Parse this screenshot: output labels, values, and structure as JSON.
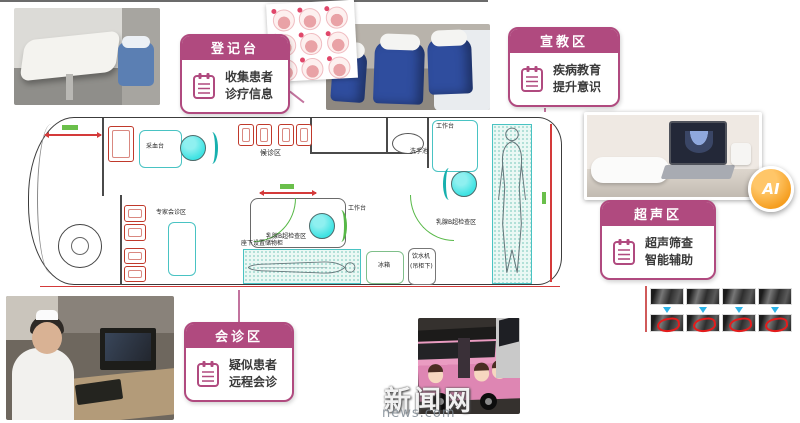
{
  "callouts": {
    "registration": {
      "title": "登记台",
      "line1": "收集患者",
      "line2": "诊疗信息"
    },
    "education": {
      "title": "宣教区",
      "line1": "疾病教育",
      "line2": "提升意识"
    },
    "ultrasound": {
      "title": "超声区",
      "line1": "超声筛查",
      "line2": "智能辅助"
    },
    "consultation": {
      "title": "会诊区",
      "line1": "疑似患者",
      "line2": "远程会诊"
    }
  },
  "floorplan": {
    "labels": {
      "blood_draw_desk": "采血台",
      "waiting_area": "候诊区",
      "worktable": "工作台",
      "sink": "洗手池",
      "expert_consult_area": "专家会诊区",
      "breast_ultrasound_area": "乳腺B超检查区",
      "underseat_storage": "座下设置储物柜",
      "fridge": "冰箱",
      "water_dispenser_line1": "饮水机",
      "water_dispenser_line2": "(吊柜下)"
    }
  },
  "ai_badge": "AI",
  "watermark": {
    "cn": "新闻网",
    "en": "news.com"
  },
  "ai_strip": {
    "top_row_images": 4,
    "bottom_row_images": 4,
    "arrow_count": 4
  },
  "poster": {
    "rows": 3,
    "cols": 3
  },
  "colors": {
    "accent_pink": "#b04a7f",
    "cyan": "#3fe3e3",
    "teal": "#17b0ae",
    "green": "#57b847",
    "red": "#d43a3a",
    "orange": "#f59d1e",
    "arrow_blue": "#2bb3e8"
  }
}
